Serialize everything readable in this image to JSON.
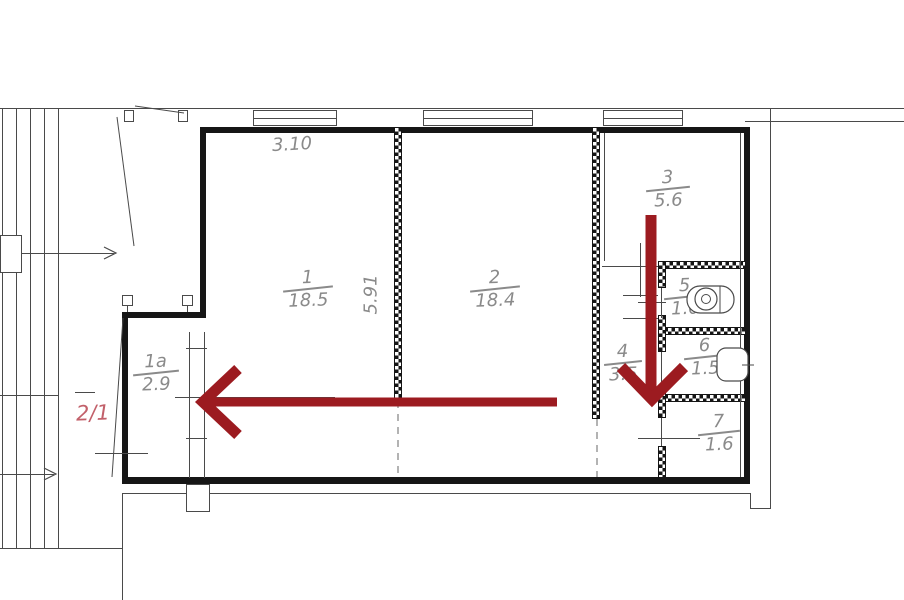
{
  "plan": {
    "unit_label": "2/1",
    "dimensions": {
      "width_m": "3.10",
      "height_m": "5.91"
    },
    "rooms": [
      {
        "number": "1",
        "area": "18.5"
      },
      {
        "number": "1a",
        "area": "2.9"
      },
      {
        "number": "2",
        "area": "18.4"
      },
      {
        "number": "3",
        "area": "5.6"
      },
      {
        "number": "4",
        "area": "3.5"
      },
      {
        "number": "5",
        "area": "1.0"
      },
      {
        "number": "6",
        "area": "1.5"
      },
      {
        "number": "7",
        "area": "1.6"
      }
    ],
    "icons": {
      "flow_arrow_left": "arrow-left",
      "flow_arrow_down": "arrow-down",
      "stair_direction": "chevron-right"
    },
    "colors": {
      "arrow": "#9c1b20",
      "unit_label": "#c2606a",
      "wall": "#161616",
      "annotation": "#8a8a8a"
    }
  }
}
